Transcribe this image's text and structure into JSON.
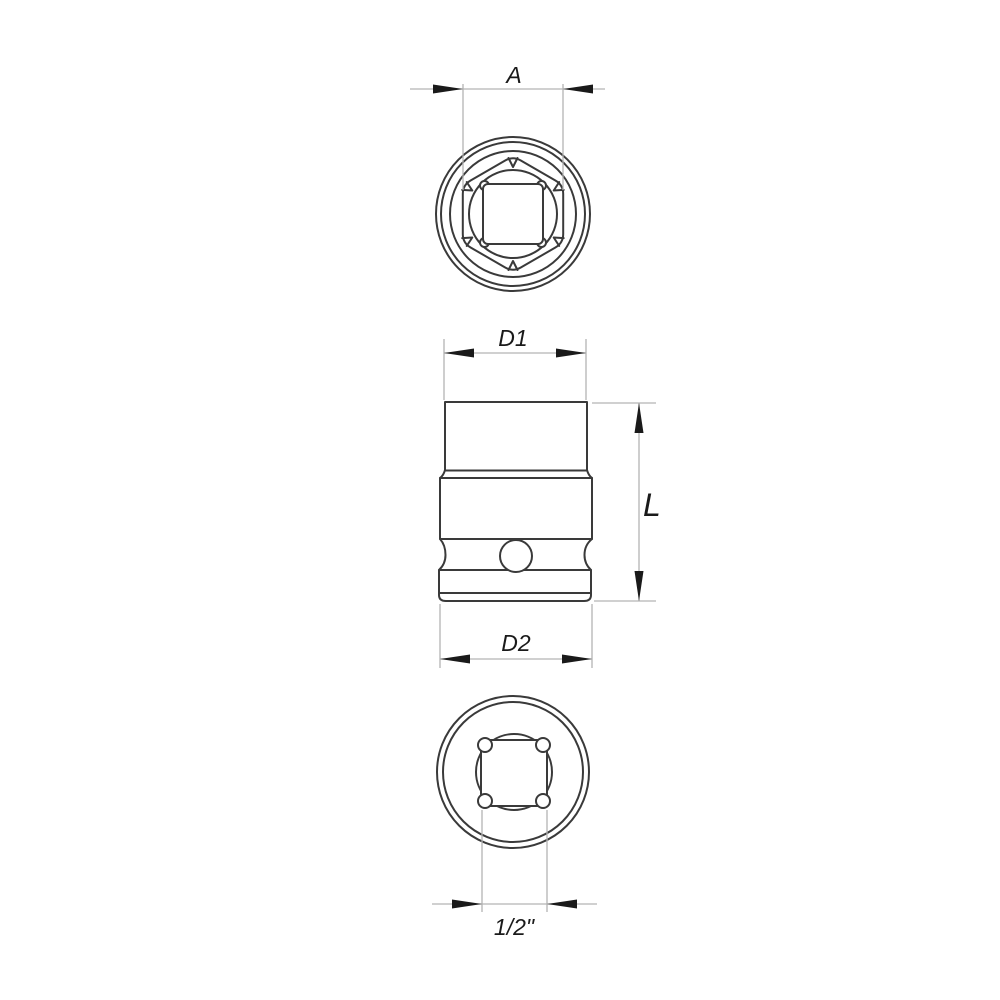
{
  "page": {
    "background": "#ffffff"
  },
  "drawing": {
    "labels": {
      "a": "A",
      "d1": "D1",
      "l": "L",
      "d2": "D2",
      "drive": "1/2\""
    },
    "colors": {
      "outline": "#3a3a3a",
      "dimension_line": "#b3b3b3",
      "arrowhead": "#1a1a1a",
      "label_text": "#1a1a1a",
      "background": "#ffffff"
    }
  }
}
